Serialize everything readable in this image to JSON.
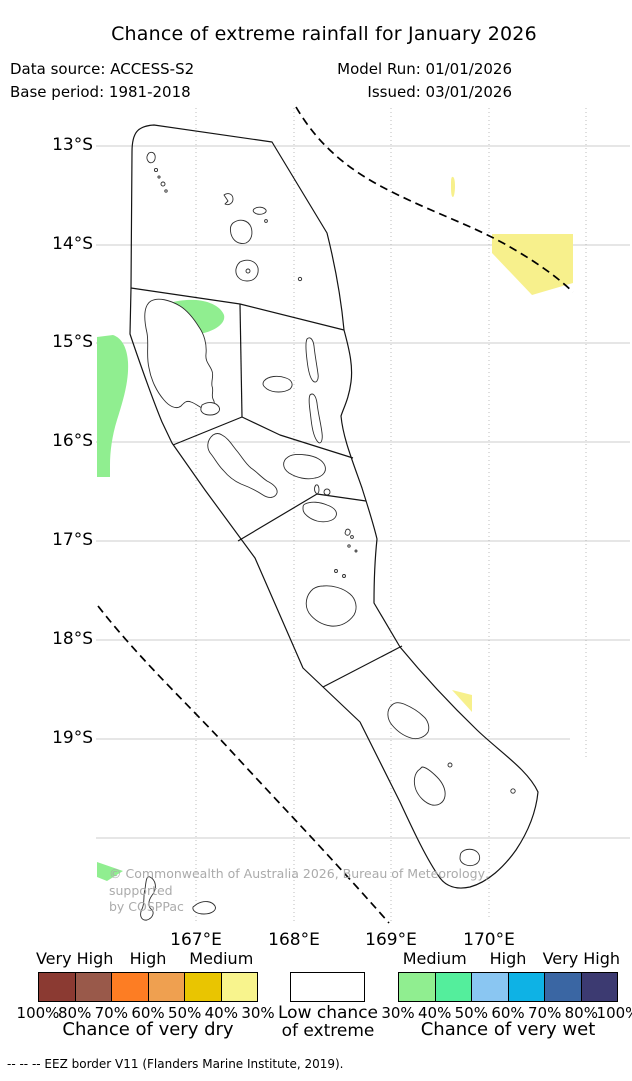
{
  "title": "Chance of extreme rainfall for January 2026",
  "header": {
    "data_source": "Data source: ACCESS-S2",
    "base_period": "Base period: 1981-2018",
    "model_run": "Model Run: 01/01/2026",
    "issued": "Issued: 03/01/2026"
  },
  "axes": {
    "lat_labels": [
      "13°S",
      "14°S",
      "15°S",
      "16°S",
      "17°S",
      "18°S",
      "19°S"
    ],
    "lon_labels": [
      "167°E",
      "168°E",
      "169°E",
      "170°E"
    ]
  },
  "map": {
    "copyright_line1": "© Commonwealth of Australia 2026, Bureau of Meteorology, supported",
    "copyright_line2": "by COSPPac"
  },
  "legend": {
    "dry": {
      "categories": [
        "Very High",
        "High",
        "Medium"
      ],
      "percents": [
        "100%",
        "80%",
        "70%",
        "60%",
        "50%",
        "40%",
        "30%"
      ],
      "colors": [
        "#8B3A32",
        "#99594A",
        "#FD7D23",
        "#EFA050",
        "#E9C501",
        "#F8F48D"
      ],
      "caption": "Chance of very dry"
    },
    "center": {
      "line1": "Low chance",
      "line2": "of extreme"
    },
    "wet": {
      "categories": [
        "Medium",
        "High",
        "Very High"
      ],
      "percents": [
        "30%",
        "40%",
        "50%",
        "60%",
        "70%",
        "80%",
        "100%"
      ],
      "colors": [
        "#90EE90",
        "#54EE9C",
        "#8AC6F2",
        "#0EB2E5",
        "#3A66A3",
        "#3C3A71"
      ],
      "caption": "Chance of very wet"
    }
  },
  "footer": {
    "eez_note": "-- -- -- EEZ border V11 (Flanders Marine Institute, 2019)."
  },
  "colors": {
    "map_very_wet_30": "#90EE90",
    "map_very_dry_30": "#F7F08C",
    "grid": "#c9c9c9",
    "boundary": "#141414"
  }
}
